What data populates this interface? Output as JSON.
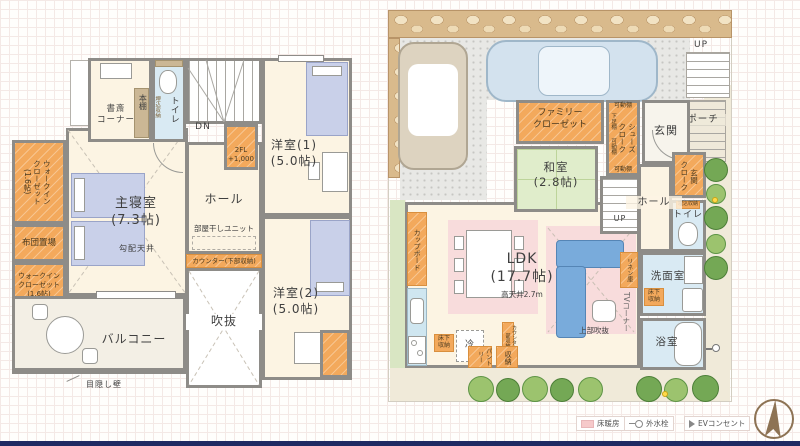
{
  "floor2": {
    "study": "書斎\nコーナー",
    "bookshelf": "本棚",
    "toilet": "トイレ",
    "recess": "埋込収納",
    "dn": "DN",
    "stair_closet": "2FL\n+1,000",
    "room1": "洋室(1)\n(5.0帖)",
    "hall": "ホール",
    "drying": "部屋干しユニット",
    "counter": "カウンター(下部収納)",
    "master": "主寝室\n(7.3帖)",
    "slope": "勾配天井",
    "wic1": "ウォークイン\nクローゼット\n(1.6帖)",
    "futon": "布団置場",
    "wic2": "ウォークイン\nクローゼット\n(1.6帖)",
    "room2": "洋室(2)\n(5.0帖)",
    "void": "吹抜",
    "balcony": "バルコニー",
    "privacy": "目隠し壁"
  },
  "floor1": {
    "up_site": "UP",
    "porch": "ポーチ",
    "entry": "玄関",
    "family_closet": "ファミリー\nクローゼット",
    "shelf_top": "可動棚",
    "geta": "下足棚",
    "shelf_mid": "可動棚",
    "shoes": "シューズ\nクローク",
    "shelf_btm": "可動棚",
    "washitsu": "和室\n(2.8帖)",
    "hall": "ホール",
    "up_stairs": "UP",
    "entry_cloak": "玄関\nクローク",
    "recess": "埋込収納",
    "toilet": "トイレ",
    "linen": "リネン庫",
    "wash": "洗面室",
    "under_wash": "床下\n収納",
    "bath": "浴室",
    "ldk": "LDK\n(17.7帖)",
    "ceiling": "高天井2.7m",
    "tv": "TVコーナー",
    "void_above": "上部吹抜",
    "cupboard": "カップボード",
    "fridge": "冷",
    "counter_store": "カウンター下部収納",
    "under_kitchen": "床下\n収納",
    "pantry": "パントリー",
    "storage": "収納"
  },
  "legend": {
    "heating": "床暖房",
    "faucet": "外水栓",
    "ev": "EVコンセント"
  },
  "colors": {
    "wall": "#8e8c88",
    "closet_orange": "#f3a95c",
    "water_blue": "#d9eaf3",
    "tatami_green": "#e0edcb",
    "floor_heating_pink": "#f8dcdc",
    "sofa_blue": "#79abdb",
    "bed_lavender": "#c9d0e9",
    "stone_tan": "#d9ba8c",
    "compass_brown": "#8d7354",
    "bottom_bar_navy": "#1f2a63"
  }
}
